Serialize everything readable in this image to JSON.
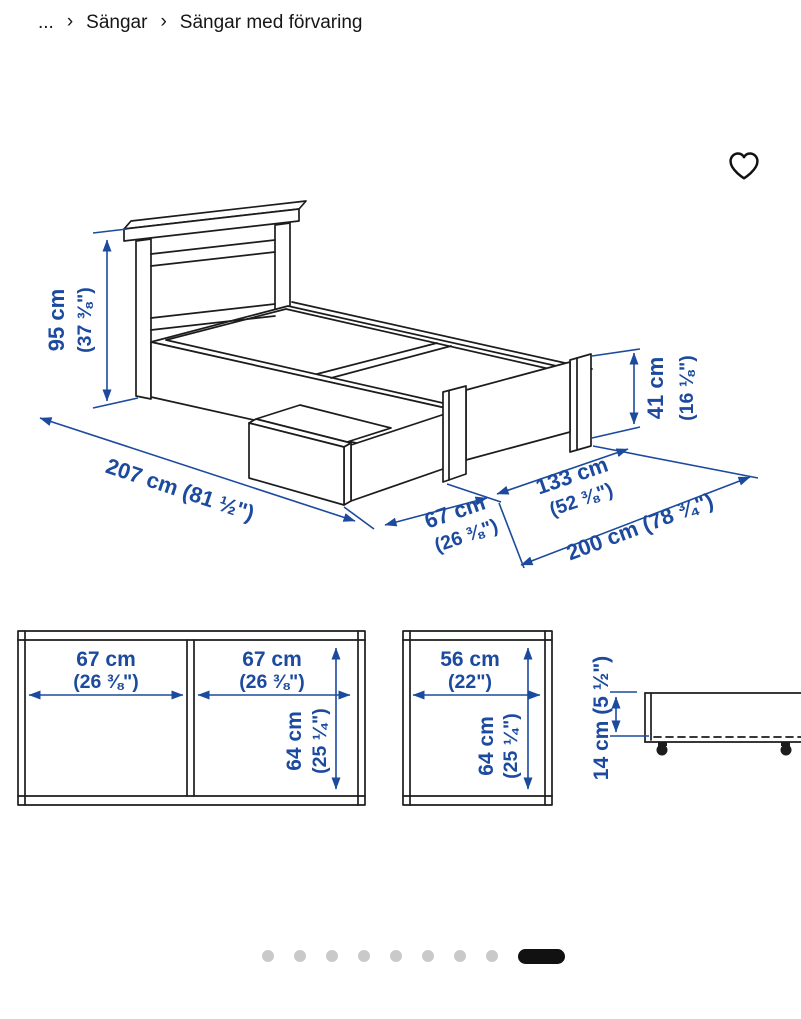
{
  "breadcrumb": {
    "ellipsis": "...",
    "separator": "›",
    "items": [
      "Sängar",
      "Sängar med förvaring"
    ]
  },
  "icons": {
    "favorite": "heart-outline-icon"
  },
  "colors": {
    "dimension_blue": "#1b4a9e",
    "drawing_black": "#1c1c1c",
    "dot_gray": "#c9c9c9",
    "active_dot_black": "#111111"
  },
  "dims": {
    "height": {
      "cm": "95 cm",
      "inch": "(37 ⅜\")"
    },
    "total_length": {
      "label": "207 cm (81 ½\")"
    },
    "foot_height": {
      "cm": "41 cm",
      "inch": "(16 ⅛\")"
    },
    "drawer_width": {
      "cm": "67 cm",
      "inch": "(26 ⅜\")"
    },
    "width": {
      "cm": "133 cm",
      "inch": "(52 ⅜\")"
    },
    "inner_length": {
      "label": "200 cm (78 ¾\")"
    }
  },
  "drawers_top": {
    "left": {
      "cm": "67 cm",
      "inch": "(26 ⅜\")"
    },
    "right": {
      "cm": "67 cm",
      "inch": "(26 ⅜\")"
    },
    "depth": {
      "cm": "64 cm",
      "inch": "(25 ¼\")"
    }
  },
  "drawer_single": {
    "width": {
      "cm": "56 cm",
      "inch": "(22\")"
    },
    "depth": {
      "cm": "64 cm",
      "inch": "(25 ¼\")"
    }
  },
  "drawer_side": {
    "height": {
      "label": "14 cm (5 ½\")"
    }
  },
  "pagination": {
    "dots": 8,
    "active_index": 9
  }
}
